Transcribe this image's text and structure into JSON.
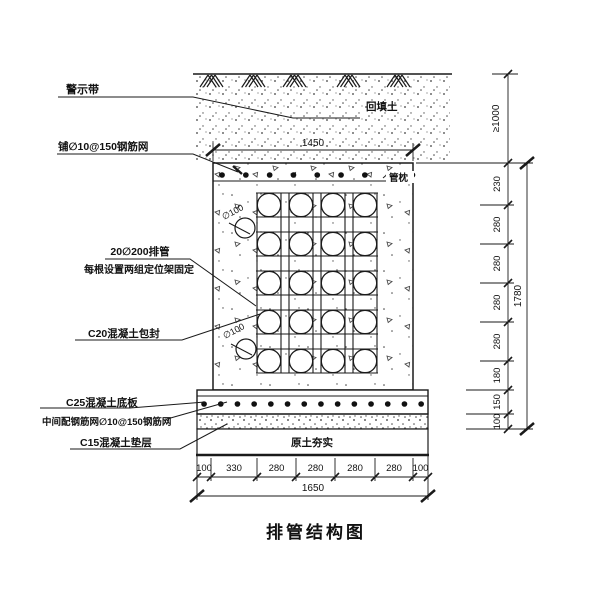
{
  "title": "排管结构图",
  "callouts": {
    "warning_tape": "警示带",
    "top_mesh": "铺∅10@150钢筋网",
    "pipe_count": "20∅200排管",
    "pipe_fixing": "每根设置两组定位架固定",
    "c20_encase": "C20混凝土包封",
    "c25_slab": "C25混凝土底板",
    "mid_mesh": "中间配钢筋网∅10@150钢筋网",
    "c15_cushion": "C15混凝土垫层",
    "backfill": "回填土",
    "pipe_pillow": "管枕",
    "compacted_soil": "原土夯实",
    "dia100": "∅100"
  },
  "dimensions": {
    "top_width": "1450",
    "cover_depth": "≥1000",
    "right_chain": [
      "230",
      "280",
      "280",
      "280",
      "280",
      "180",
      "150",
      "100"
    ],
    "right_total": "1780",
    "bottom_chain": [
      "100",
      "330",
      "280",
      "280",
      "280",
      "280",
      "100"
    ],
    "bottom_total": "1650"
  },
  "colors": {
    "line": "#1a1a1a",
    "background": "#ffffff"
  }
}
